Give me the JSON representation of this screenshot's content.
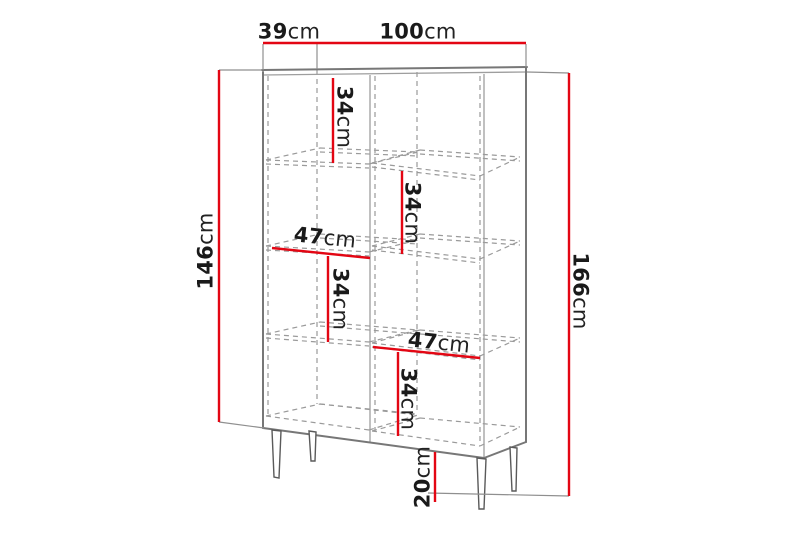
{
  "diagram_title": "cabinet-dimension-diagram",
  "dimensions": {
    "depth": {
      "value": "39",
      "unit": "cm"
    },
    "width": {
      "value": "100",
      "unit": "cm"
    },
    "carcass_height": {
      "value": "146",
      "unit": "cm"
    },
    "total_height": {
      "value": "166",
      "unit": "cm"
    },
    "shelf_spacing_top_left": {
      "value": "34",
      "unit": "cm"
    },
    "shelf_spacing_upper_right": {
      "value": "34",
      "unit": "cm"
    },
    "shelf_spacing_middle_left": {
      "value": "34",
      "unit": "cm"
    },
    "shelf_spacing_lower_right": {
      "value": "34",
      "unit": "cm"
    },
    "compartment_width_left": {
      "value": "47",
      "unit": "cm"
    },
    "compartment_width_right": {
      "value": "47",
      "unit": "cm"
    },
    "leg_height": {
      "value": "20",
      "unit": "cm"
    }
  },
  "colors": {
    "dimension_line": "#e30613",
    "edge": "#777777",
    "hidden_line": "#9a9a9a",
    "extension_line": "#8f8f8f",
    "text": "#1a1a1a",
    "background": "#ffffff"
  }
}
